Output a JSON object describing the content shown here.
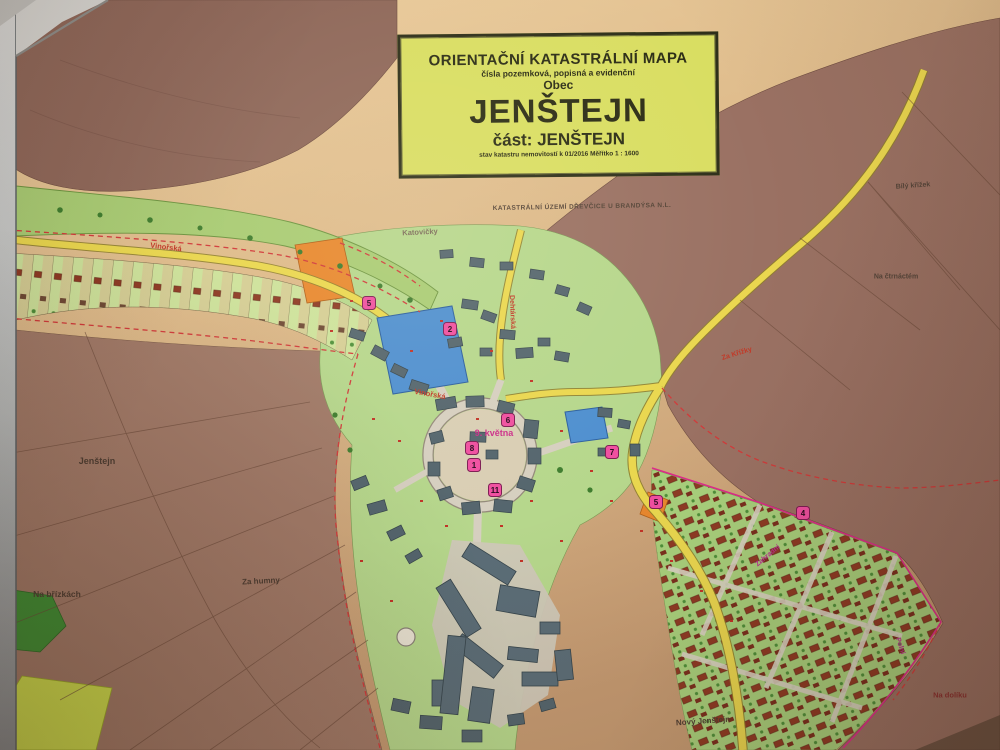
{
  "title_box": {
    "line1": "ORIENTAČNÍ KATASTRÁLNÍ MAPA",
    "line2": "čísla pozemková, popisná a evidenční",
    "line3": "Obec",
    "line4": "JENŠTEJN",
    "line5": "část: JENŠTEJN",
    "line6": "stav katastru nemovitostí k 01/2016   Měřítko 1 : 1600"
  },
  "subtitle": "KATASTRÁLNÍ ÚZEMÍ DŘEVČICE U BRANDÝSA N.L.",
  "place_labels": [
    {
      "text": "Katovičky"
    },
    {
      "text": "Jenštejn"
    },
    {
      "text": "Na břízkách"
    },
    {
      "text": "Za humny"
    },
    {
      "text": "Bílý křížek"
    },
    {
      "text": "Na čtrnáctém"
    },
    {
      "text": "Nový Jenštejn"
    },
    {
      "text": "Na dolíku"
    }
  ],
  "street_labels": [
    {
      "text": "Vinořská"
    },
    {
      "text": "Vinořská"
    },
    {
      "text": "9. května"
    },
    {
      "text": "Dehtárská"
    },
    {
      "text": "Za Křížky"
    },
    {
      "text": "Zahradní"
    },
    {
      "text": "Polní"
    }
  ],
  "badges": [
    {
      "number": "5"
    },
    {
      "number": "2"
    },
    {
      "number": "6"
    },
    {
      "number": "8"
    },
    {
      "number": "1"
    },
    {
      "number": "11"
    },
    {
      "number": "7"
    },
    {
      "number": "5"
    },
    {
      "number": "4"
    }
  ],
  "colors": {
    "paper_tan": "#dcb888",
    "field_brown": "#9a7163",
    "village_green": "#b6d78c",
    "creek_green": "#a9cc74",
    "road_yellow": "#ead74f",
    "street_gray": "#d6cfc0",
    "water_blue": "#4e8fd0",
    "orange_parcel": "#e8882e",
    "building_slate": "#54656d",
    "boundary_red_dashed": "#d13b3b",
    "boundary_magenta": "#dd2b8a",
    "badge_pink": "#f04fa0",
    "title_bg": "#d9de62",
    "frame_gray": "#c9cccb"
  }
}
